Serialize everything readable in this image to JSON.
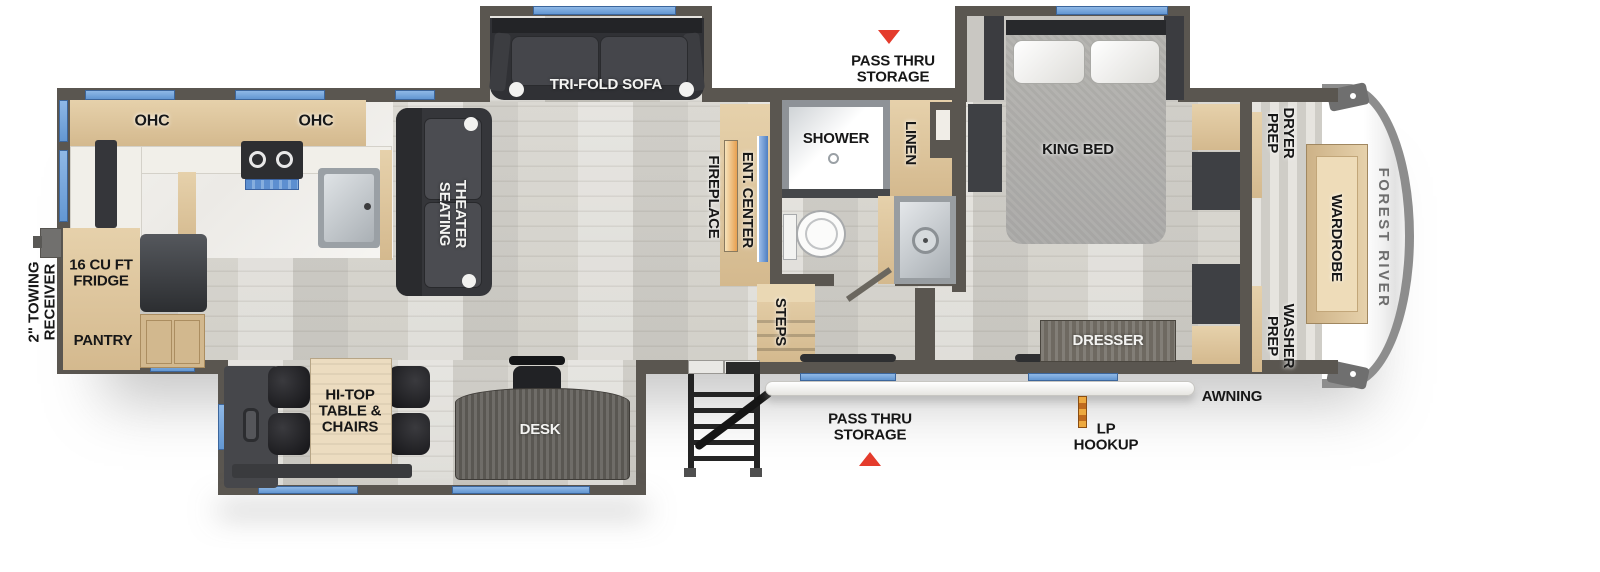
{
  "labels": {
    "ohc_left": "OHC",
    "ohc_right": "OHC",
    "tri_fold_sofa": "TRI-FOLD SOFA",
    "pass_thru_top": "PASS THRU\nSTORAGE",
    "king_bed": "KING BED",
    "dryer_prep": "DRYER\nPREP",
    "wardrobe": "WARDROBE",
    "forest_river": "FOREST RIVER",
    "washer_prep": "WASHER\nPREP",
    "linen": "LINEN",
    "shower": "SHOWER",
    "ent_center": "ENT. CENTER",
    "fireplace": "FIREPLACE",
    "theater_seating": "THEATER\nSEATING",
    "towing_receiver": "2\" TOWING\nRECEIVER",
    "fridge": "16 CU FT\nFRIDGE",
    "pantry": "PANTRY",
    "hi_top_table": "HI-TOP\nTABLE &\nCHAIRS",
    "desk": "DESK",
    "steps": "STEPS",
    "dresser": "DRESSER",
    "awning": "AWNING",
    "lp_hookup": "LP\nHOOKUP",
    "pass_thru_bottom": "PASS THRU\nSTORAGE"
  },
  "colors": {
    "wall": "#5a5650",
    "floor_wood": "#d8d6d0",
    "kitchen_floor": "#f2f1ed",
    "cabinet_tan": "#e0c9a2",
    "furniture_dark": "#3b3c40",
    "window_blue": "#79a9de",
    "tv_blue": "#5d8fd0",
    "fireplace_orange": "#e8a050",
    "arrow_red": "#e43b2c",
    "awning_white": "#f7f6f3",
    "lp_orange": "#e0892f"
  }
}
